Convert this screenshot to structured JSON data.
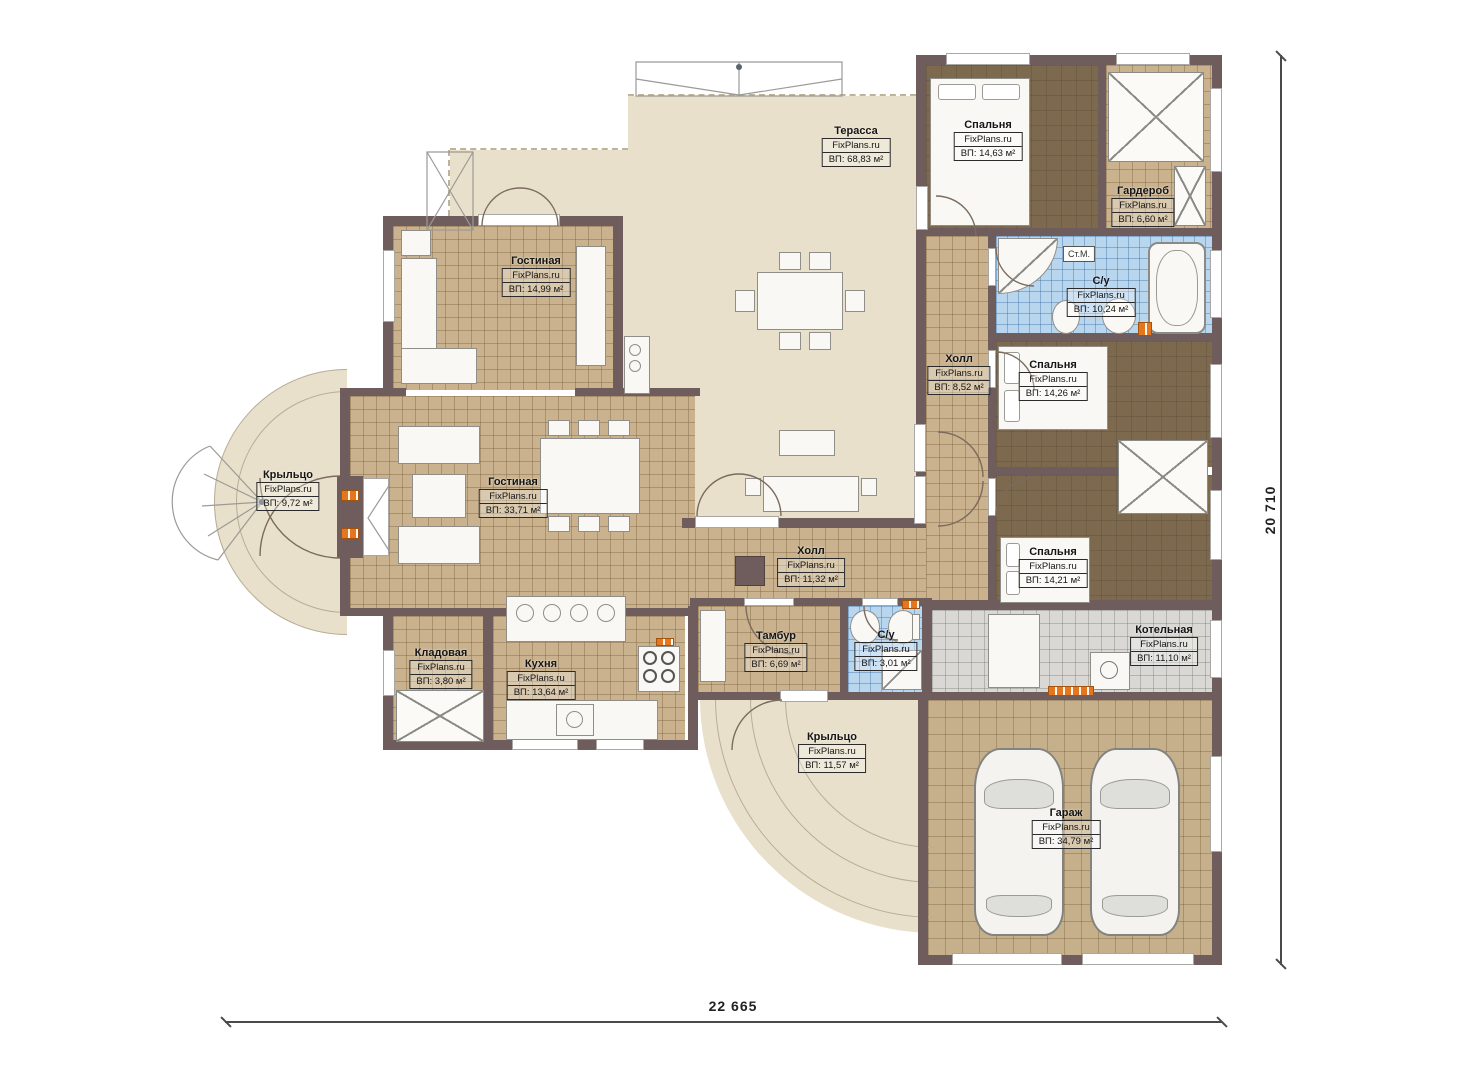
{
  "watermark": "FixPlans.ru",
  "rooms": [
    {
      "name": "Терасса",
      "area": "ВП: 68,83 м²"
    },
    {
      "name": "Спальня",
      "area": "ВП: 14,63 м²"
    },
    {
      "name": "Гардероб",
      "area": "ВП: 6,60 м²"
    },
    {
      "name": "Гостиная",
      "area": "ВП: 14,99 м²"
    },
    {
      "name": "С/у",
      "area": "ВП: 10,24 м²"
    },
    {
      "name": "Холл",
      "area": "ВП: 8,52 м²"
    },
    {
      "name": "Спальня",
      "area": "ВП: 14,26 м²"
    },
    {
      "name": "Крыльцо",
      "area": "ВП: 9,72 м²"
    },
    {
      "name": "Гостиная",
      "area": "ВП: 33,71 м²"
    },
    {
      "name": "Холл",
      "area": "ВП: 11,32 м²"
    },
    {
      "name": "Спальня",
      "area": "ВП: 14,21 м²"
    },
    {
      "name": "Кладовая",
      "area": "ВП: 3,80 м²"
    },
    {
      "name": "Кухня",
      "area": "ВП: 13,64 м²"
    },
    {
      "name": "Тамбур",
      "area": "ВП: 6,69 м²"
    },
    {
      "name": "С/у",
      "area": "ВП: 3,01 м²"
    },
    {
      "name": "Котельная",
      "area": "ВП: 11,10 м²"
    },
    {
      "name": "Крыльцо",
      "area": "ВП: 11,57 м²"
    },
    {
      "name": "Гараж",
      "area": "ВП: 34,79 м²"
    }
  ],
  "labels": {
    "washing_machine": "Ст.М."
  },
  "dimensions": {
    "width_label": "22 665",
    "height_label": "20 710"
  },
  "colors": {
    "wall": "#6f5d5d",
    "terrace_floor": "#e9e0cb",
    "tile_floor": "#c9b28d",
    "bedroom_floor": "#7d6a4e",
    "bathroom_tile": "#b9d6ef",
    "boiler_tile": "#d9d8d4",
    "radiator": "#e6761e"
  }
}
